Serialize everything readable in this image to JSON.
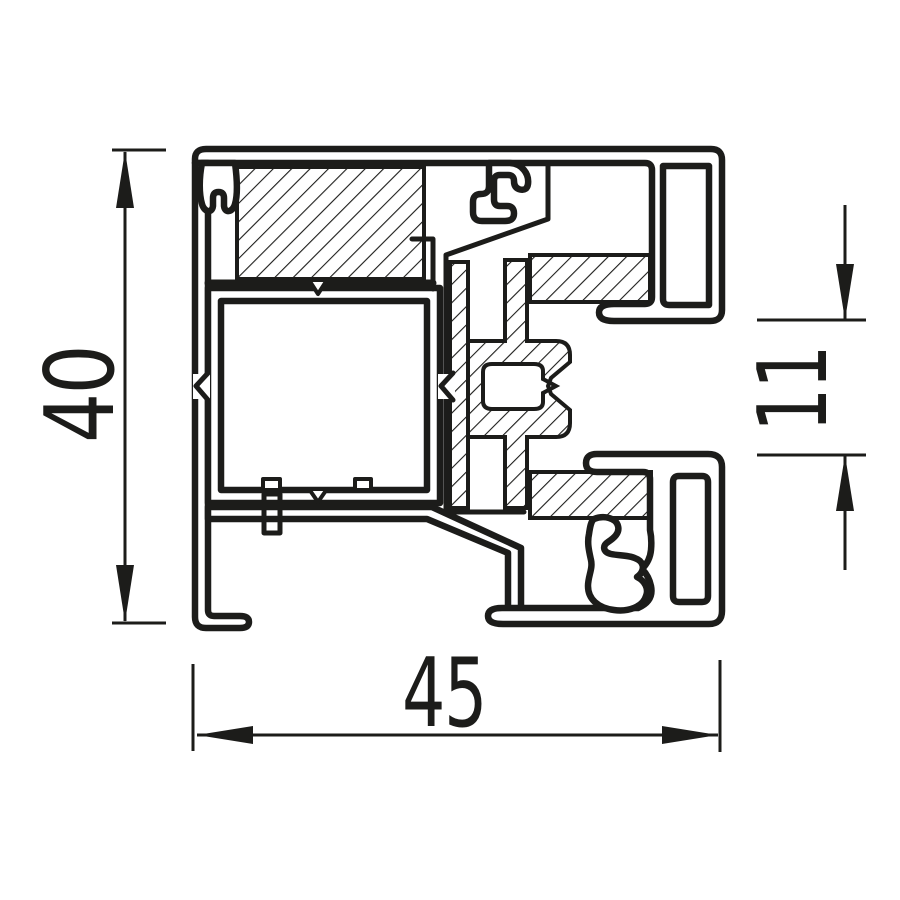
{
  "drawing": {
    "type": "technical-profile-cross-section",
    "dimensions": {
      "height": {
        "value": "40"
      },
      "width": {
        "value": "45"
      },
      "detail": {
        "value": "11"
      }
    },
    "colors": {
      "line": "#1c1c1a",
      "background": "#ffffff"
    }
  }
}
